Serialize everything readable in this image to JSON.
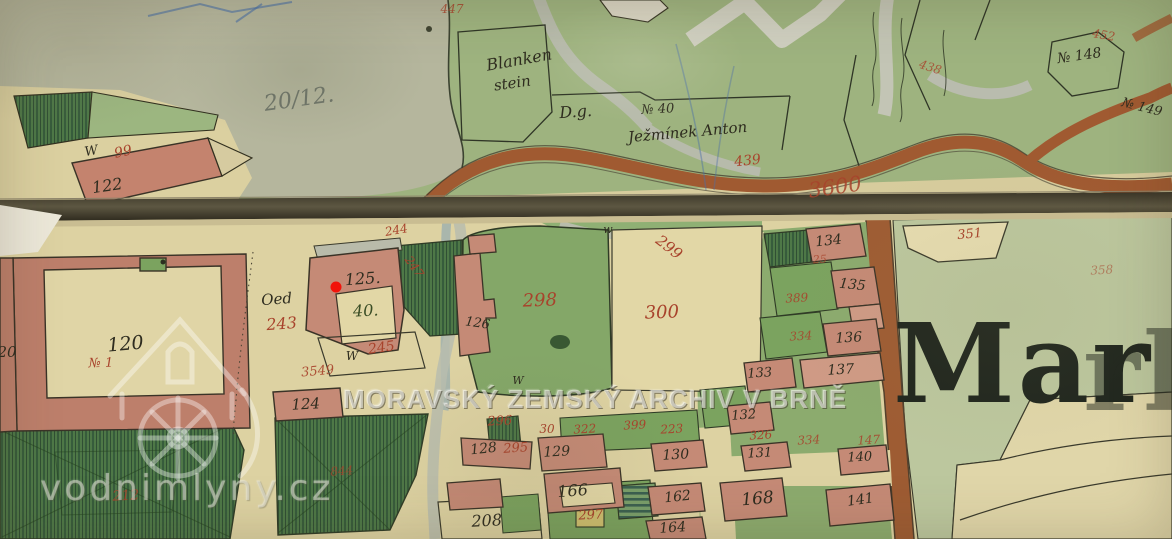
{
  "watermarks": {
    "archive_text": "MORAVSKÝ ZEMSKÝ ARCHIV V BRNĚ",
    "site_text": "vodnimlyny.cz",
    "logo_icon": "watermill-house-icon"
  },
  "sheet_title": {
    "visible": "Mar",
    "ghost": "rk"
  },
  "marker": {
    "shape": "red-dot",
    "color": "#f2130a",
    "at_plot": "125"
  },
  "colors": {
    "red": "#a8432c",
    "black": "#2e2c1f",
    "dkgreen": "#3a4d25",
    "pencil": "#70766a",
    "road_brown": "#a05a31",
    "building_pink": "#c58a76",
    "garden_green": "#7ba35f",
    "paper": "#ddd2a2"
  },
  "labels": [
    {
      "t": "20/12.",
      "x": 300,
      "y": 106,
      "s": 22,
      "c": "pencil",
      "r": -8
    },
    {
      "t": "Blanken",
      "x": 520,
      "y": 65,
      "s": 16,
      "c": "black",
      "r": -10
    },
    {
      "t": "stein",
      "x": 513,
      "y": 88,
      "s": 15,
      "c": "black",
      "r": -8
    },
    {
      "t": "D.g.",
      "x": 576,
      "y": 117,
      "s": 16,
      "c": "black",
      "r": -4
    },
    {
      "t": "№ 40",
      "x": 658,
      "y": 113,
      "s": 13,
      "c": "black",
      "r": -3
    },
    {
      "t": "Ježmínek Anton",
      "x": 688,
      "y": 137,
      "s": 15,
      "c": "black",
      "r": -5
    },
    {
      "t": "439",
      "x": 748,
      "y": 165,
      "s": 14,
      "c": "red",
      "r": -6
    },
    {
      "t": "3600",
      "x": 836,
      "y": 194,
      "s": 21,
      "c": "red",
      "r": -8,
      "o": 0.85
    },
    {
      "t": "447",
      "x": 452,
      "y": 13,
      "s": 12,
      "c": "red",
      "r": 0,
      "o": 0.85
    },
    {
      "t": "438",
      "x": 929,
      "y": 71,
      "s": 12,
      "c": "red",
      "r": 18,
      "o": 0.8
    },
    {
      "t": "452",
      "x": 1103,
      "y": 39,
      "s": 12,
      "c": "red",
      "r": 10,
      "o": 0.85
    },
    {
      "t": "№ 148",
      "x": 1080,
      "y": 60,
      "s": 14,
      "c": "black",
      "r": -8
    },
    {
      "t": "№ 149",
      "x": 1141,
      "y": 111,
      "s": 13,
      "c": "black",
      "r": 14
    },
    {
      "t": "W",
      "x": 92,
      "y": 155,
      "s": 13,
      "c": "black",
      "r": -10
    },
    {
      "t": "99",
      "x": 124,
      "y": 156,
      "s": 14,
      "c": "red",
      "r": -12
    },
    {
      "t": "122",
      "x": 108,
      "y": 191,
      "s": 16,
      "c": "black",
      "r": -8
    },
    {
      "t": "120",
      "x": 126,
      "y": 350,
      "s": 19,
      "c": "black",
      "r": -5
    },
    {
      "t": "№ 1",
      "x": 101,
      "y": 367,
      "s": 13,
      "c": "red",
      "r": -2
    },
    {
      "t": "20",
      "x": 7,
      "y": 357,
      "s": 15,
      "c": "black",
      "r": 0
    },
    {
      "t": "Oed",
      "x": 277,
      "y": 304,
      "s": 15,
      "c": "black",
      "r": -4
    },
    {
      "t": "243",
      "x": 282,
      "y": 329,
      "s": 16,
      "c": "red",
      "r": -4
    },
    {
      "t": "125.",
      "x": 363,
      "y": 284,
      "s": 16,
      "c": "black",
      "r": -4
    },
    {
      "t": "40.",
      "x": 366,
      "y": 316,
      "s": 16,
      "c": "dkgreen",
      "r": -3
    },
    {
      "t": "W",
      "x": 352,
      "y": 360,
      "s": 12,
      "c": "black",
      "r": 0
    },
    {
      "t": "245",
      "x": 382,
      "y": 352,
      "s": 14,
      "c": "red",
      "r": -8
    },
    {
      "t": "3549",
      "x": 318,
      "y": 375,
      "s": 13,
      "c": "red",
      "r": -5,
      "o": 0.9
    },
    {
      "t": "124",
      "x": 306,
      "y": 409,
      "s": 15,
      "c": "black",
      "r": -3
    },
    {
      "t": "844",
      "x": 342,
      "y": 475,
      "s": 12,
      "c": "red",
      "r": -4,
      "o": 0.75
    },
    {
      "t": "212",
      "x": 126,
      "y": 500,
      "s": 14,
      "c": "red",
      "r": -3,
      "o": 0.85
    },
    {
      "t": "244",
      "x": 397,
      "y": 234,
      "s": 12,
      "c": "red",
      "r": -10
    },
    {
      "t": "247",
      "x": 411,
      "y": 269,
      "s": 12,
      "c": "red",
      "r": 55
    },
    {
      "t": "w",
      "x": 608,
      "y": 233,
      "s": 11,
      "c": "black",
      "r": 0
    },
    {
      "t": "299",
      "x": 666,
      "y": 251,
      "s": 15,
      "c": "red",
      "r": 38
    },
    {
      "t": "298",
      "x": 540,
      "y": 306,
      "s": 18,
      "c": "red",
      "r": -2
    },
    {
      "t": "300",
      "x": 662,
      "y": 318,
      "s": 18,
      "c": "red",
      "r": -2
    },
    {
      "t": "126",
      "x": 477,
      "y": 327,
      "s": 13,
      "c": "black",
      "r": 8
    },
    {
      "t": "W",
      "x": 518,
      "y": 384,
      "s": 11,
      "c": "black",
      "r": 0
    },
    {
      "t": "296",
      "x": 500,
      "y": 425,
      "s": 13,
      "c": "red",
      "r": -3
    },
    {
      "t": "128",
      "x": 484,
      "y": 453,
      "s": 14,
      "c": "black",
      "r": -6
    },
    {
      "t": "295",
      "x": 516,
      "y": 452,
      "s": 13,
      "c": "red",
      "r": -4
    },
    {
      "t": "30",
      "x": 547,
      "y": 433,
      "s": 12,
      "c": "red",
      "r": 0
    },
    {
      "t": "129",
      "x": 557,
      "y": 456,
      "s": 14,
      "c": "black",
      "r": -3
    },
    {
      "t": "322",
      "x": 585,
      "y": 433,
      "s": 12,
      "c": "red",
      "r": -3
    },
    {
      "t": "399",
      "x": 635,
      "y": 429,
      "s": 12,
      "c": "red",
      "r": -3
    },
    {
      "t": "223",
      "x": 672,
      "y": 433,
      "s": 12,
      "c": "red",
      "r": -3
    },
    {
      "t": "130",
      "x": 676,
      "y": 459,
      "s": 14,
      "c": "black",
      "r": -3
    },
    {
      "t": "166",
      "x": 573,
      "y": 496,
      "s": 16,
      "c": "black",
      "r": -4
    },
    {
      "t": "297",
      "x": 591,
      "y": 519,
      "s": 13,
      "c": "red",
      "r": -3
    },
    {
      "t": "208",
      "x": 487,
      "y": 526,
      "s": 16,
      "c": "black",
      "r": -3
    },
    {
      "t": "162",
      "x": 678,
      "y": 501,
      "s": 14,
      "c": "black",
      "r": -6
    },
    {
      "t": "164",
      "x": 673,
      "y": 532,
      "s": 14,
      "c": "black",
      "r": -4
    },
    {
      "t": "168",
      "x": 758,
      "y": 504,
      "s": 17,
      "c": "black",
      "r": -5
    },
    {
      "t": "141",
      "x": 861,
      "y": 504,
      "s": 14,
      "c": "black",
      "r": -8
    },
    {
      "t": "140",
      "x": 860,
      "y": 461,
      "s": 13,
      "c": "black",
      "r": -3
    },
    {
      "t": "147",
      "x": 869,
      "y": 444,
      "s": 12,
      "c": "red",
      "r": -3,
      "o": 0.85
    },
    {
      "t": "326",
      "x": 761,
      "y": 439,
      "s": 12,
      "c": "red",
      "r": -3
    },
    {
      "t": "334",
      "x": 809,
      "y": 444,
      "s": 12,
      "c": "red",
      "r": -3,
      "o": 0.85
    },
    {
      "t": "131",
      "x": 760,
      "y": 457,
      "s": 13,
      "c": "black",
      "r": -3
    },
    {
      "t": "132",
      "x": 744,
      "y": 419,
      "s": 13,
      "c": "black",
      "r": -4
    },
    {
      "t": "133",
      "x": 760,
      "y": 377,
      "s": 13,
      "c": "black",
      "r": -4
    },
    {
      "t": "137",
      "x": 841,
      "y": 374,
      "s": 14,
      "c": "black",
      "r": -3
    },
    {
      "t": "136",
      "x": 849,
      "y": 342,
      "s": 14,
      "c": "black",
      "r": -3
    },
    {
      "t": "135",
      "x": 852,
      "y": 289,
      "s": 14,
      "c": "black",
      "r": 6
    },
    {
      "t": "134",
      "x": 829,
      "y": 245,
      "s": 14,
      "c": "black",
      "r": -6
    },
    {
      "t": "25",
      "x": 820,
      "y": 263,
      "s": 11,
      "c": "red",
      "r": -3,
      "o": 0.8
    },
    {
      "t": "389",
      "x": 797,
      "y": 302,
      "s": 12,
      "c": "red",
      "r": -3,
      "o": 0.9
    },
    {
      "t": "334",
      "x": 801,
      "y": 340,
      "s": 12,
      "c": "red",
      "r": -3,
      "o": 0.85
    },
    {
      "t": "351",
      "x": 970,
      "y": 238,
      "s": 13,
      "c": "red",
      "r": -5
    },
    {
      "t": "358",
      "x": 1102,
      "y": 274,
      "s": 12,
      "c": "red",
      "r": -3,
      "o": 0.55
    }
  ]
}
